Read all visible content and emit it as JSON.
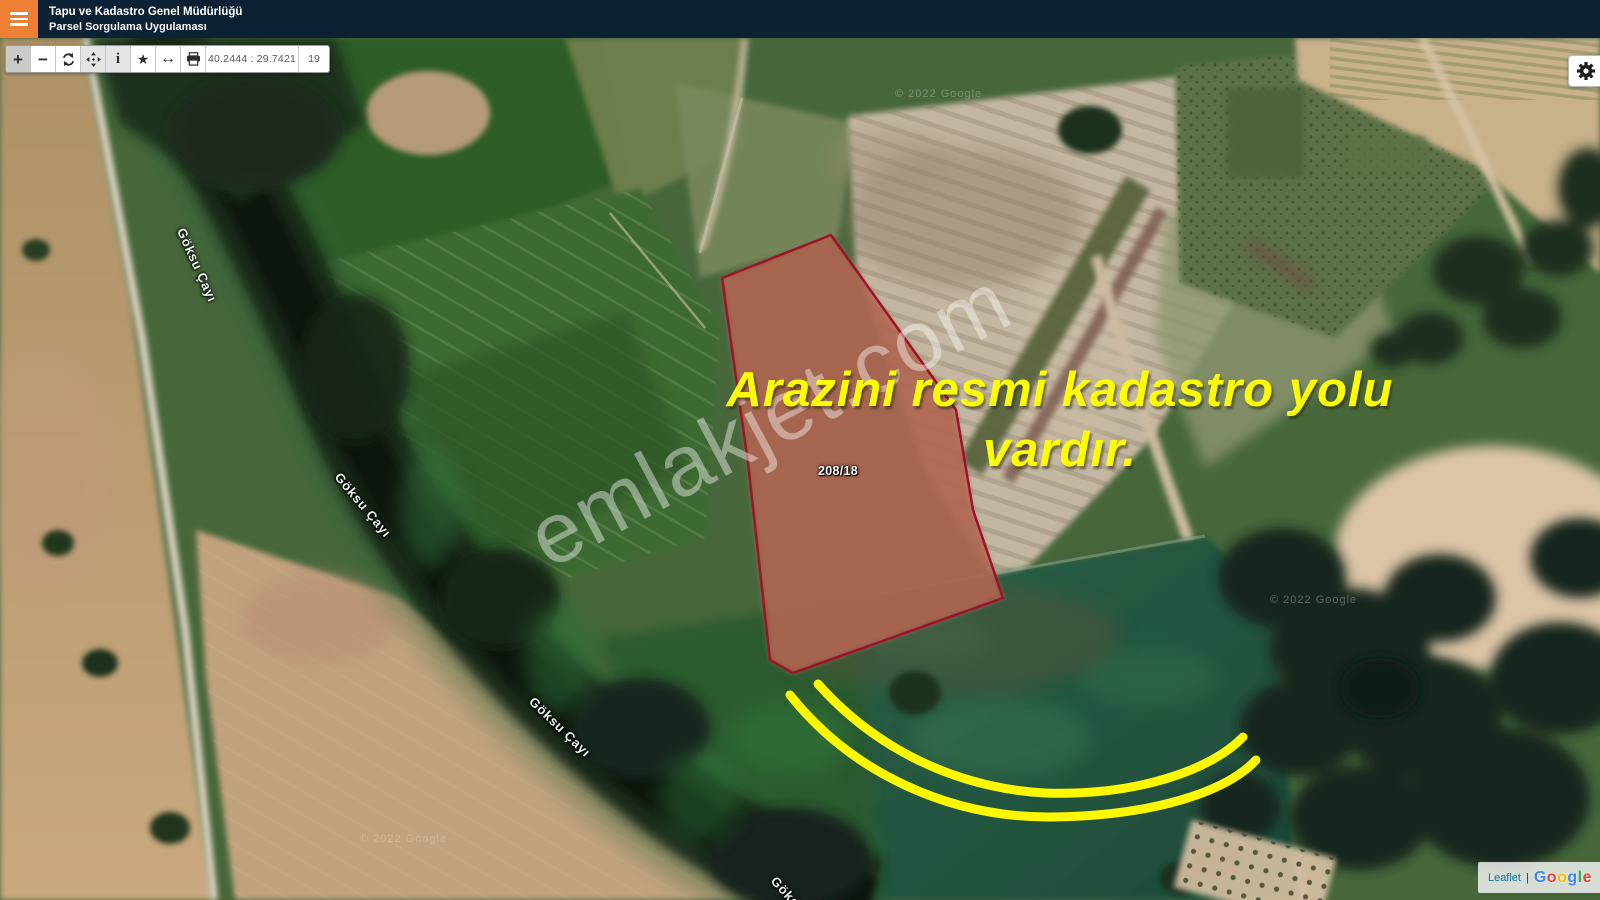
{
  "header": {
    "title_line1": "Tapu ve Kadastro Genel Müdürlüğü",
    "title_line2": "Parsel Sorgulama Uygulaması",
    "colors": {
      "bar_bg": "#0d2134",
      "menu_bg": "#ef7f33"
    }
  },
  "toolbar": {
    "coordinates": "40.2444 : 29.7421",
    "zoom_level": "19",
    "buttons": [
      {
        "name": "zoom-in",
        "glyph": "+",
        "active": true,
        "highlighted": false
      },
      {
        "name": "zoom-out",
        "glyph": "−",
        "active": false,
        "highlighted": false
      },
      {
        "name": "refresh",
        "glyph": "",
        "active": false,
        "highlighted": false
      },
      {
        "name": "pan",
        "glyph": "",
        "active": false,
        "highlighted": true
      },
      {
        "name": "info",
        "glyph": "i",
        "active": false,
        "highlighted": true
      },
      {
        "name": "favorites",
        "glyph": "★",
        "active": false,
        "highlighted": false
      },
      {
        "name": "measure",
        "glyph": "↔",
        "active": false,
        "highlighted": false
      },
      {
        "name": "print",
        "glyph": "",
        "active": false,
        "highlighted": false
      }
    ]
  },
  "map": {
    "parcel": {
      "label": "208/18",
      "stroke_color": "#9f1128",
      "fill_color": "rgba(205,70,60,0.4)"
    },
    "note": {
      "line1": "Arazini resmi kadastro yolu",
      "line2": "vardır.",
      "color": "#fdfd02"
    },
    "highlight_road_color": "#fdf800",
    "river_label": "Göksu Çayı",
    "watermark": "emlakjet.com",
    "imagery_credits": [
      "© 2022 Google",
      "© 2022 Google",
      "© 2022 Google"
    ]
  },
  "attribution": {
    "leaflet": "Leaflet",
    "separator": "|",
    "google": [
      {
        "ch": "G",
        "color": "#4285F4"
      },
      {
        "ch": "o",
        "color": "#EA4335"
      },
      {
        "ch": "o",
        "color": "#FBBC05"
      },
      {
        "ch": "g",
        "color": "#4285F4"
      },
      {
        "ch": "l",
        "color": "#34A853"
      },
      {
        "ch": "e",
        "color": "#EA4335"
      }
    ]
  }
}
